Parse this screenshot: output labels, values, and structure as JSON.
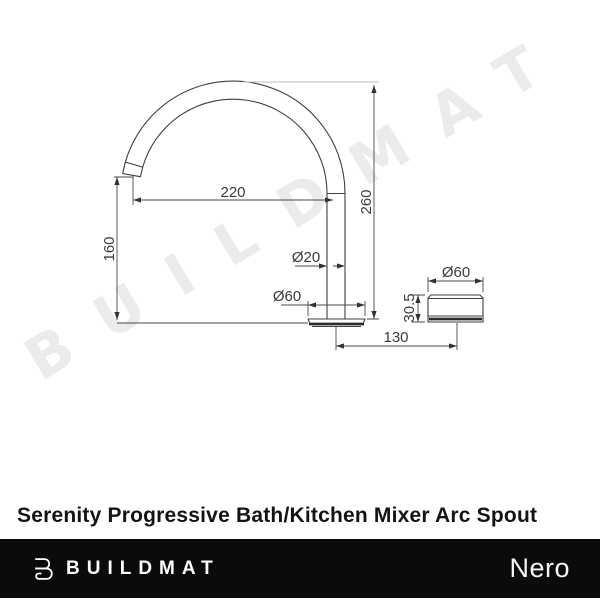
{
  "watermark": {
    "text": "BUILDMAT",
    "color": "#ebebeb"
  },
  "drawing": {
    "line_color": "#3f3f3f",
    "dimensions": {
      "spout_reach": {
        "label": "220"
      },
      "spout_height": {
        "label": "260"
      },
      "tip_clearance": {
        "label": "160"
      },
      "pipe_diameter": {
        "label": "Ø20"
      },
      "base_diameter": {
        "label": "Ø60"
      },
      "body_diameter": {
        "label": "Ø60"
      },
      "body_height": {
        "label": "30.5"
      },
      "centre_distance": {
        "label": "130"
      }
    }
  },
  "title": "Serenity Progressive Bath/Kitchen Mixer Arc Spout",
  "footer": {
    "brand_name": "BUILDMAT",
    "logo_icon": "buildmat-b-icon",
    "partner_brand": "Nero",
    "background": "#0b0b0b"
  }
}
